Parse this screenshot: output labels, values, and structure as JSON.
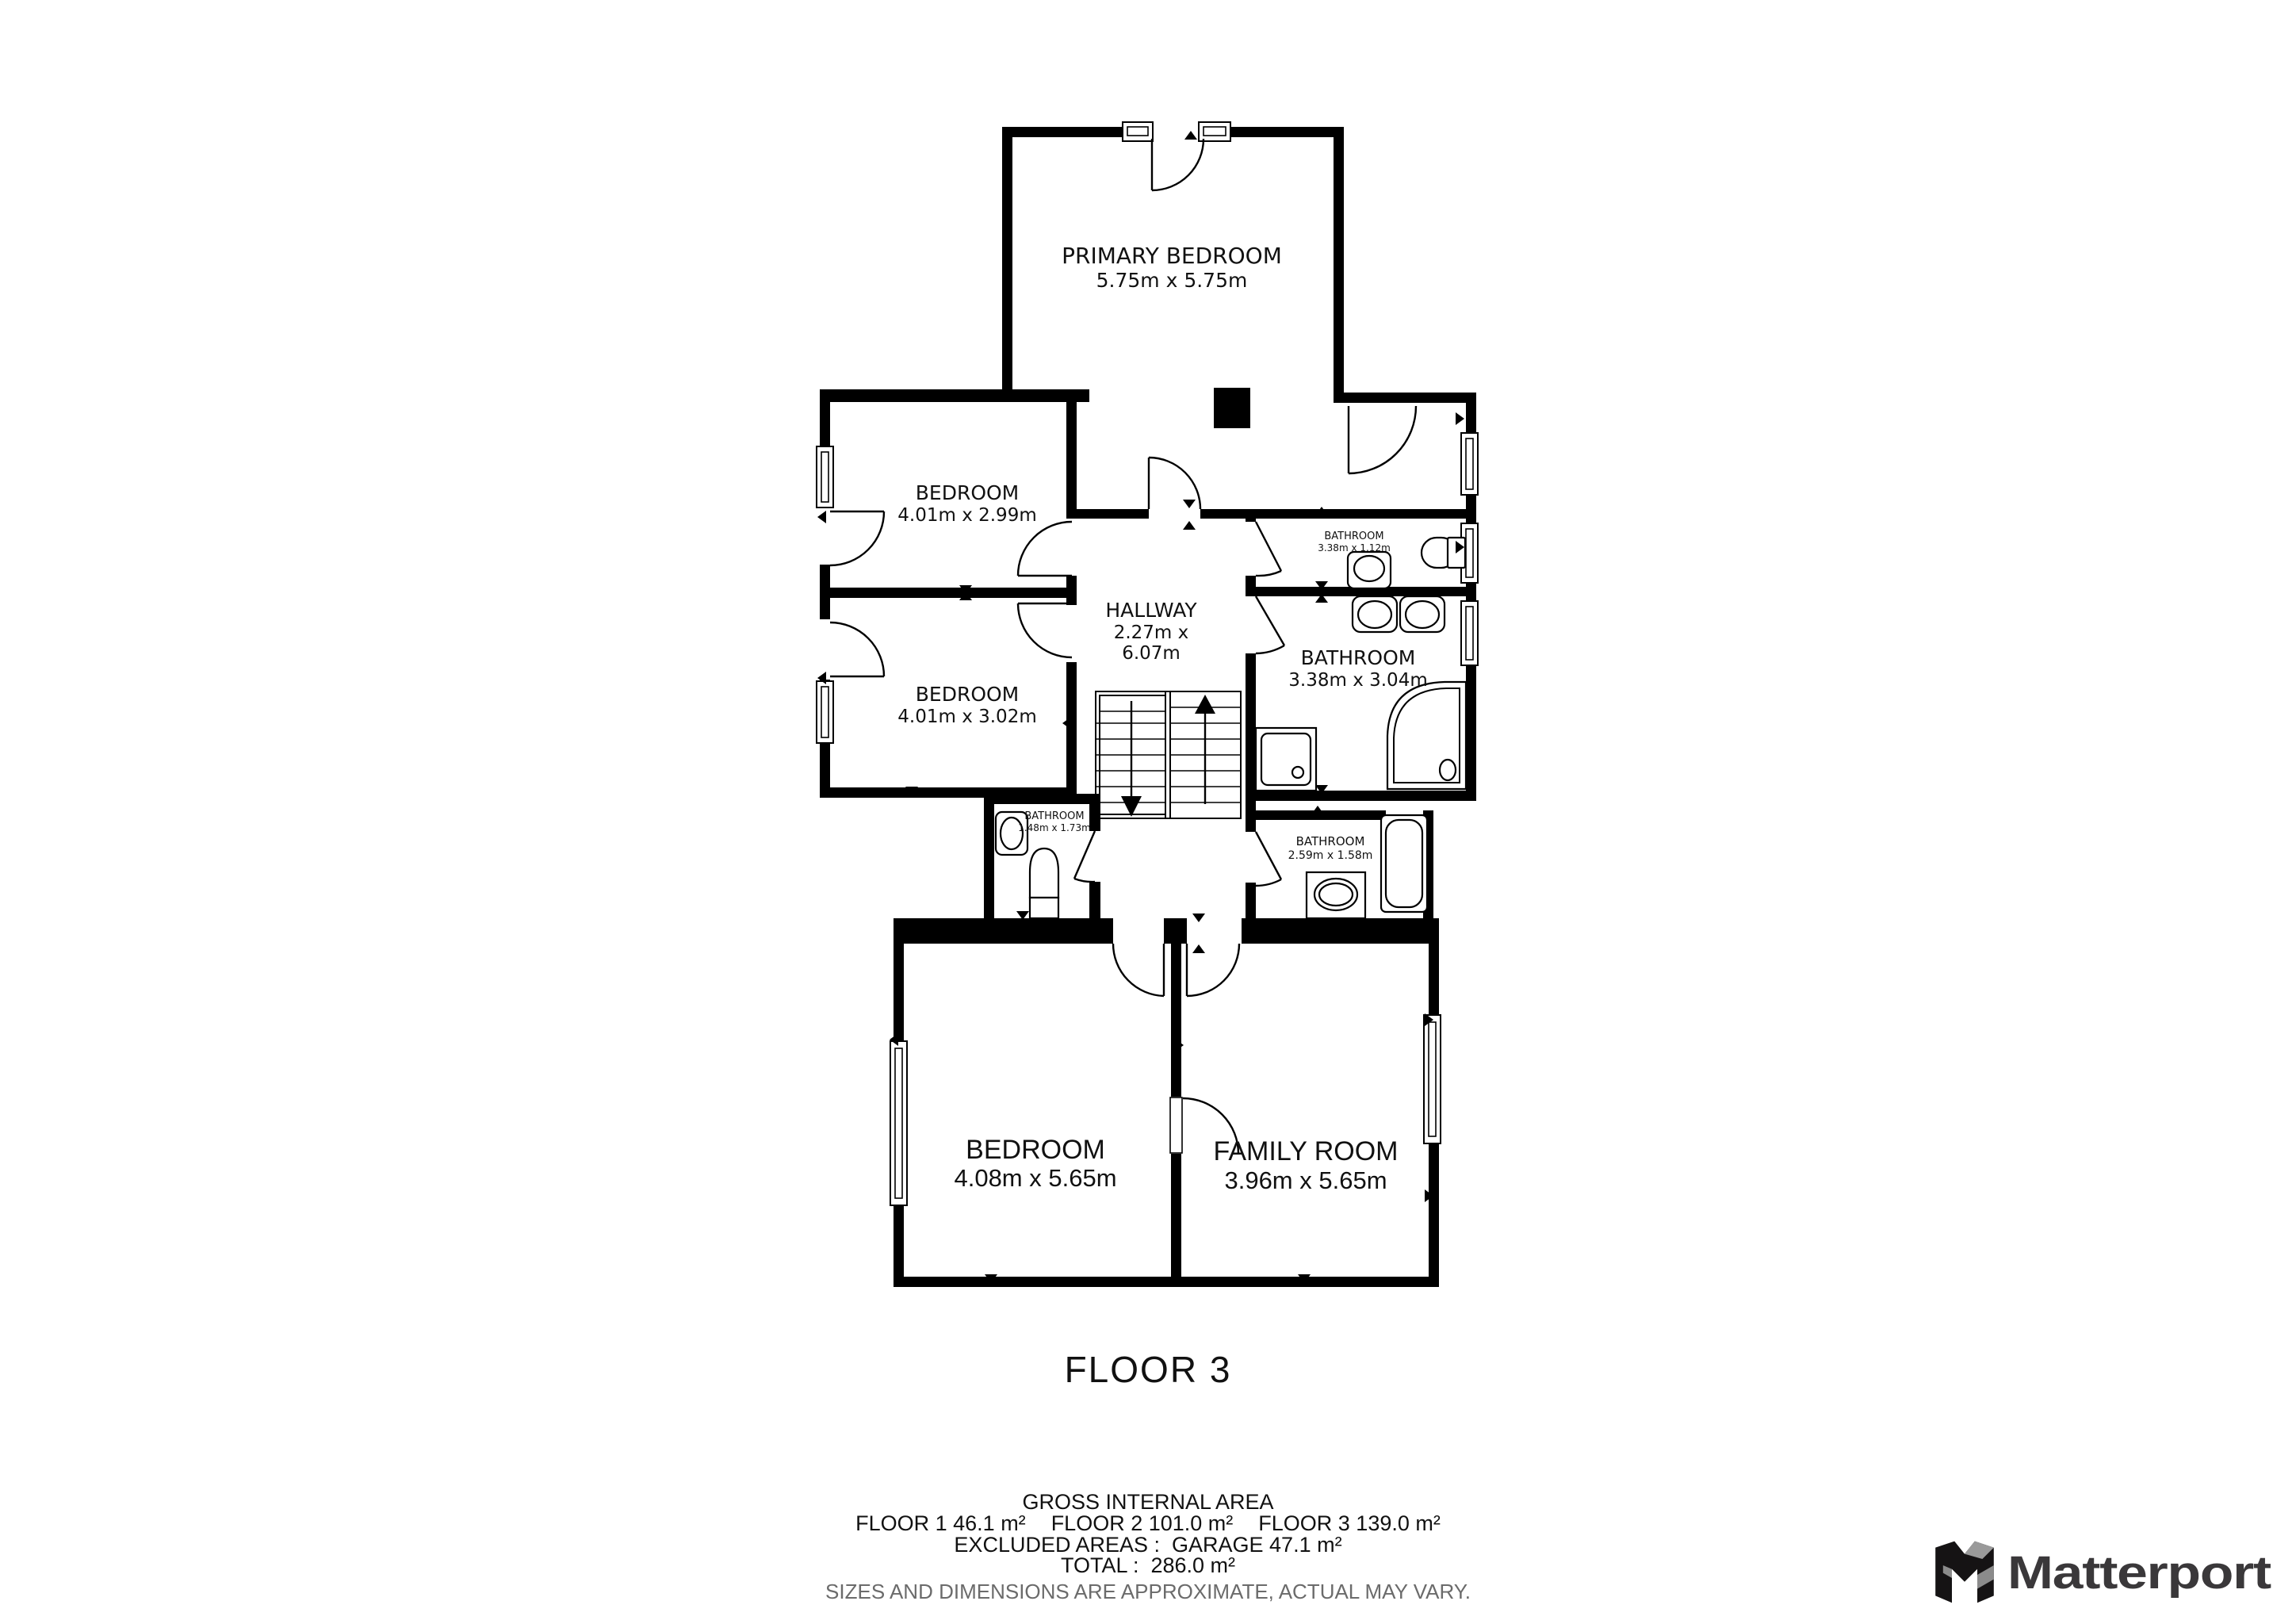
{
  "floor_plan": {
    "title": "FLOOR 3",
    "rooms": [
      {
        "name": "PRIMARY BEDROOM",
        "dims": "5.75m x 5.75m"
      },
      {
        "name": "BEDROOM",
        "dims": "4.01m x 2.99m"
      },
      {
        "name": "BEDROOM",
        "dims": "4.01m x 3.02m"
      },
      {
        "name": "HALLWAY",
        "dims_line1": "2.27m x",
        "dims_line2": "6.07m"
      },
      {
        "name": "BATHROOM",
        "dims": "3.38m x 1.12m"
      },
      {
        "name": "BATHROOM",
        "dims": "3.38m x 3.04m"
      },
      {
        "name": "BATHROOM",
        "dims": "1.48m x 1.73m"
      },
      {
        "name": "BATHROOM",
        "dims": "2.59m x 1.58m"
      },
      {
        "name": "BEDROOM",
        "dims": "4.08m x 5.65m"
      },
      {
        "name": "FAMILY ROOM",
        "dims": "3.96m x 5.65m"
      }
    ]
  },
  "footer": {
    "gross_internal_area": "GROSS INTERNAL AREA",
    "floor_areas": [
      "FLOOR 1 46.1 m²",
      "FLOOR 2 101.0 m²",
      "FLOOR 3 139.0 m²"
    ],
    "excluded_areas": "EXCLUDED AREAS :  GARAGE 47.1 m²",
    "total": "TOTAL :  286.0 m²",
    "disclaimer": "SIZES AND DIMENSIONS ARE APPROXIMATE, ACTUAL MAY VARY."
  },
  "branding": {
    "wordmark": "Matterport"
  },
  "colors": {
    "wall": "#000000",
    "label": "#111111",
    "disclaimer": "#6b6b6b",
    "logo_text": "#3a383a",
    "logo_gray": "#9a9a9a"
  }
}
